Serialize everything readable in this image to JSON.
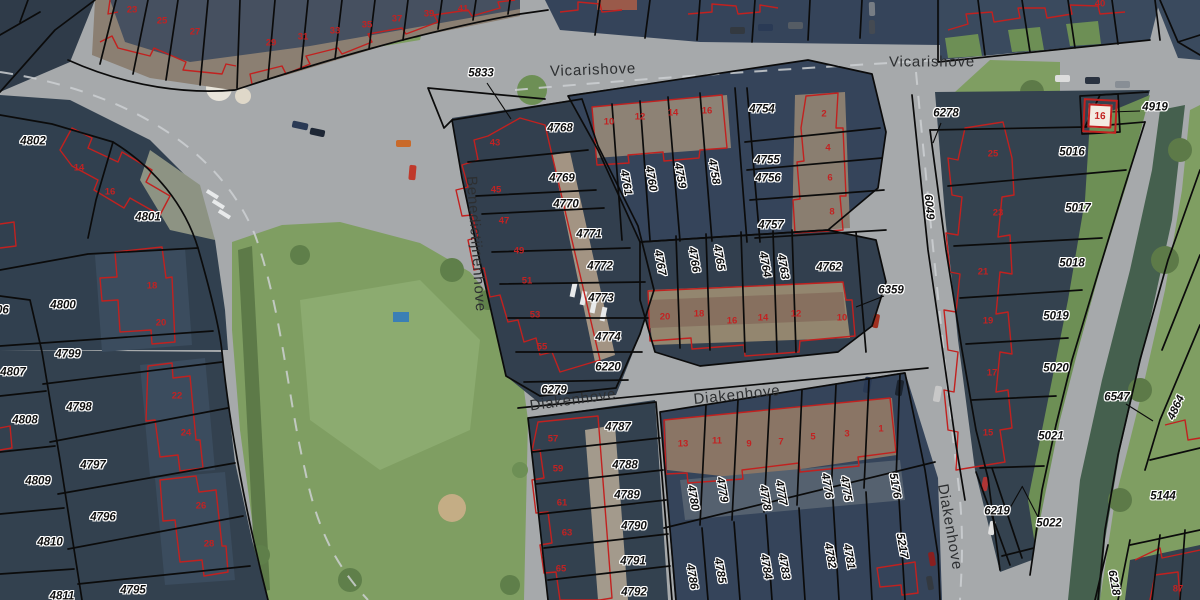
{
  "map": {
    "colors": {
      "road": "#a6a9ab",
      "grass": "#7f9e62",
      "water": "#45604e",
      "roof_dark": "#31404f",
      "roof_brown": "#8a7466",
      "parcel_boundary": "#0b0b0b",
      "building_outline": "#c2211f",
      "parcel_label": "#0e0e0e",
      "street_label": "#2d2f31",
      "house_number": "#c22222"
    },
    "street_labels": [
      {
        "text": "Vicarishove",
        "x": 593,
        "y": 70,
        "rot": -2
      },
      {
        "text": "Vicarishove",
        "x": 932,
        "y": 62,
        "rot": 0
      },
      {
        "text": "Benedictijnenhove",
        "x": 476,
        "y": 244,
        "rot": 86
      },
      {
        "text": "Diakenhove",
        "x": 573,
        "y": 400,
        "rot": -8
      },
      {
        "text": "Diakenhove",
        "x": 737,
        "y": 395,
        "rot": -6
      },
      {
        "text": "Diakenhove",
        "x": 950,
        "y": 527,
        "rot": 80
      }
    ],
    "parcel_labels": [
      {
        "text": "5833",
        "x": 481,
        "y": 74,
        "rot": 0
      },
      {
        "text": "4768",
        "x": 560,
        "y": 129,
        "rot": 0
      },
      {
        "text": "4769",
        "x": 562,
        "y": 179,
        "rot": 0
      },
      {
        "text": "4770",
        "x": 566,
        "y": 205,
        "rot": 0
      },
      {
        "text": "4771",
        "x": 589,
        "y": 235,
        "rot": 0
      },
      {
        "text": "4772",
        "x": 600,
        "y": 267,
        "rot": 0
      },
      {
        "text": "4773",
        "x": 601,
        "y": 299,
        "rot": 0
      },
      {
        "text": "4774",
        "x": 608,
        "y": 338,
        "rot": 0
      },
      {
        "text": "6220",
        "x": 608,
        "y": 368,
        "rot": 0
      },
      {
        "text": "6279",
        "x": 554,
        "y": 391,
        "rot": 0
      },
      {
        "text": "4754",
        "x": 762,
        "y": 110,
        "rot": 0
      },
      {
        "text": "4755",
        "x": 767,
        "y": 161,
        "rot": 0
      },
      {
        "text": "4756",
        "x": 768,
        "y": 179,
        "rot": 0
      },
      {
        "text": "4757",
        "x": 771,
        "y": 226,
        "rot": 0
      },
      {
        "text": "4761",
        "x": 625,
        "y": 183,
        "rot": 80
      },
      {
        "text": "4760",
        "x": 650,
        "y": 179,
        "rot": 80
      },
      {
        "text": "4759",
        "x": 679,
        "y": 176,
        "rot": 80
      },
      {
        "text": "4758",
        "x": 713,
        "y": 172,
        "rot": 80
      },
      {
        "text": "4767",
        "x": 659,
        "y": 263,
        "rot": 80
      },
      {
        "text": "4766",
        "x": 693,
        "y": 260,
        "rot": 80
      },
      {
        "text": "4765",
        "x": 718,
        "y": 258,
        "rot": 80
      },
      {
        "text": "4764",
        "x": 764,
        "y": 265,
        "rot": 80
      },
      {
        "text": "4763",
        "x": 782,
        "y": 267,
        "rot": 80
      },
      {
        "text": "4762",
        "x": 829,
        "y": 268,
        "rot": 0
      },
      {
        "text": "6359",
        "x": 891,
        "y": 291,
        "rot": 0
      },
      {
        "text": "6278",
        "x": 946,
        "y": 114,
        "rot": 0
      },
      {
        "text": "4919",
        "x": 1155,
        "y": 108,
        "rot": 0
      },
      {
        "text": "5016",
        "x": 1072,
        "y": 153,
        "rot": 0
      },
      {
        "text": "5017",
        "x": 1078,
        "y": 209,
        "rot": 0
      },
      {
        "text": "5018",
        "x": 1072,
        "y": 264,
        "rot": 0
      },
      {
        "text": "5019",
        "x": 1056,
        "y": 317,
        "rot": 0
      },
      {
        "text": "5020",
        "x": 1056,
        "y": 369,
        "rot": 0
      },
      {
        "text": "5021",
        "x": 1051,
        "y": 437,
        "rot": 0
      },
      {
        "text": "5022",
        "x": 1049,
        "y": 524,
        "rot": 0
      },
      {
        "text": "6547",
        "x": 1117,
        "y": 398,
        "rot": 0
      },
      {
        "text": "5144",
        "x": 1163,
        "y": 497,
        "rot": 0
      },
      {
        "text": "6219",
        "x": 997,
        "y": 512,
        "rot": 0
      },
      {
        "text": "6049",
        "x": 928,
        "y": 207,
        "rot": 85
      },
      {
        "text": "4864",
        "x": 1177,
        "y": 408,
        "rot": -65
      },
      {
        "text": "6218",
        "x": 1113,
        "y": 583,
        "rot": 80
      },
      {
        "text": "4802",
        "x": 33,
        "y": 142,
        "rot": 0
      },
      {
        "text": "4801",
        "x": 148,
        "y": 218,
        "rot": 0
      },
      {
        "text": "4800",
        "x": 63,
        "y": 306,
        "rot": 0
      },
      {
        "text": "4806",
        "x": -4,
        "y": 311,
        "rot": 0
      },
      {
        "text": "4807",
        "x": 13,
        "y": 373,
        "rot": 0
      },
      {
        "text": "4799",
        "x": 68,
        "y": 355,
        "rot": 0
      },
      {
        "text": "4798",
        "x": 79,
        "y": 408,
        "rot": 0
      },
      {
        "text": "4808",
        "x": 25,
        "y": 421,
        "rot": 0
      },
      {
        "text": "4797",
        "x": 93,
        "y": 466,
        "rot": 0
      },
      {
        "text": "4809",
        "x": 38,
        "y": 482,
        "rot": 0
      },
      {
        "text": "4796",
        "x": 103,
        "y": 518,
        "rot": 0
      },
      {
        "text": "4810",
        "x": 50,
        "y": 543,
        "rot": 0
      },
      {
        "text": "4795",
        "x": 133,
        "y": 591,
        "rot": 0
      },
      {
        "text": "4811",
        "x": 62,
        "y": 597,
        "rot": 0
      },
      {
        "text": "4787",
        "x": 618,
        "y": 428,
        "rot": 0
      },
      {
        "text": "4788",
        "x": 625,
        "y": 466,
        "rot": 0
      },
      {
        "text": "4789",
        "x": 627,
        "y": 496,
        "rot": 0
      },
      {
        "text": "4790",
        "x": 634,
        "y": 527,
        "rot": 0
      },
      {
        "text": "4791",
        "x": 633,
        "y": 562,
        "rot": 0
      },
      {
        "text": "4792",
        "x": 634,
        "y": 593,
        "rot": 0
      },
      {
        "text": "4780",
        "x": 692,
        "y": 498,
        "rot": 80
      },
      {
        "text": "4779",
        "x": 721,
        "y": 490,
        "rot": 80
      },
      {
        "text": "4778",
        "x": 764,
        "y": 498,
        "rot": 80
      },
      {
        "text": "4777",
        "x": 780,
        "y": 493,
        "rot": 80
      },
      {
        "text": "4776",
        "x": 826,
        "y": 486,
        "rot": 80
      },
      {
        "text": "4775",
        "x": 845,
        "y": 489,
        "rot": 80
      },
      {
        "text": "5176",
        "x": 894,
        "y": 486,
        "rot": 80
      },
      {
        "text": "4786",
        "x": 691,
        "y": 577,
        "rot": 80
      },
      {
        "text": "4785",
        "x": 719,
        "y": 571,
        "rot": 80
      },
      {
        "text": "4784",
        "x": 765,
        "y": 567,
        "rot": 80
      },
      {
        "text": "4783",
        "x": 783,
        "y": 567,
        "rot": 80
      },
      {
        "text": "4782",
        "x": 829,
        "y": 556,
        "rot": 80
      },
      {
        "text": "4781",
        "x": 848,
        "y": 557,
        "rot": 80
      },
      {
        "text": "5217",
        "x": 901,
        "y": 546,
        "rot": 80
      }
    ],
    "house_number_labels": [
      {
        "text": "23",
        "x": 132,
        "y": 10
      },
      {
        "text": "25",
        "x": 162,
        "y": 21
      },
      {
        "text": "27",
        "x": 195,
        "y": 32
      },
      {
        "text": "29",
        "x": 271,
        "y": 43
      },
      {
        "text": "31",
        "x": 303,
        "y": 37
      },
      {
        "text": "33",
        "x": 335,
        "y": 31
      },
      {
        "text": "35",
        "x": 367,
        "y": 25
      },
      {
        "text": "37",
        "x": 397,
        "y": 19
      },
      {
        "text": "39",
        "x": 429,
        "y": 14
      },
      {
        "text": "41",
        "x": 463,
        "y": 9
      },
      {
        "text": "10",
        "x": 609,
        "y": 122
      },
      {
        "text": "12",
        "x": 640,
        "y": 117
      },
      {
        "text": "14",
        "x": 673,
        "y": 113
      },
      {
        "text": "16",
        "x": 707,
        "y": 111
      },
      {
        "text": "2",
        "x": 824,
        "y": 114
      },
      {
        "text": "4",
        "x": 828,
        "y": 148
      },
      {
        "text": "6",
        "x": 830,
        "y": 178
      },
      {
        "text": "8",
        "x": 832,
        "y": 212
      },
      {
        "text": "20",
        "x": 665,
        "y": 317
      },
      {
        "text": "18",
        "x": 699,
        "y": 314
      },
      {
        "text": "16",
        "x": 732,
        "y": 321
      },
      {
        "text": "14",
        "x": 763,
        "y": 318
      },
      {
        "text": "12",
        "x": 796,
        "y": 314
      },
      {
        "text": "10",
        "x": 842,
        "y": 318
      },
      {
        "text": "43",
        "x": 495,
        "y": 143
      },
      {
        "text": "45",
        "x": 496,
        "y": 190
      },
      {
        "text": "47",
        "x": 504,
        "y": 221
      },
      {
        "text": "49",
        "x": 519,
        "y": 251
      },
      {
        "text": "51",
        "x": 527,
        "y": 281
      },
      {
        "text": "53",
        "x": 535,
        "y": 315
      },
      {
        "text": "55",
        "x": 542,
        "y": 347
      },
      {
        "text": "57",
        "x": 553,
        "y": 439
      },
      {
        "text": "59",
        "x": 558,
        "y": 469
      },
      {
        "text": "61",
        "x": 562,
        "y": 503
      },
      {
        "text": "63",
        "x": 567,
        "y": 533
      },
      {
        "text": "65",
        "x": 561,
        "y": 569
      },
      {
        "text": "13",
        "x": 683,
        "y": 444
      },
      {
        "text": "11",
        "x": 717,
        "y": 441
      },
      {
        "text": "9",
        "x": 749,
        "y": 444
      },
      {
        "text": "7",
        "x": 781,
        "y": 442
      },
      {
        "text": "5",
        "x": 813,
        "y": 437
      },
      {
        "text": "3",
        "x": 847,
        "y": 434
      },
      {
        "text": "1",
        "x": 881,
        "y": 429
      },
      {
        "text": "14",
        "x": 79,
        "y": 168
      },
      {
        "text": "16",
        "x": 110,
        "y": 192
      },
      {
        "text": "18",
        "x": 152,
        "y": 286
      },
      {
        "text": "20",
        "x": 161,
        "y": 323
      },
      {
        "text": "22",
        "x": 177,
        "y": 396
      },
      {
        "text": "24",
        "x": 186,
        "y": 433
      },
      {
        "text": "26",
        "x": 201,
        "y": 506
      },
      {
        "text": "28",
        "x": 209,
        "y": 544
      },
      {
        "text": "25",
        "x": 993,
        "y": 154
      },
      {
        "text": "23",
        "x": 998,
        "y": 213
      },
      {
        "text": "21",
        "x": 983,
        "y": 272
      },
      {
        "text": "19",
        "x": 988,
        "y": 321
      },
      {
        "text": "17",
        "x": 992,
        "y": 373
      },
      {
        "text": "15",
        "x": 988,
        "y": 433
      },
      {
        "text": "40",
        "x": 1100,
        "y": 4
      },
      {
        "text": "87",
        "x": 1178,
        "y": 589
      }
    ],
    "boxed_house_number": {
      "text": "16",
      "x": 1100,
      "y": 116
    }
  }
}
